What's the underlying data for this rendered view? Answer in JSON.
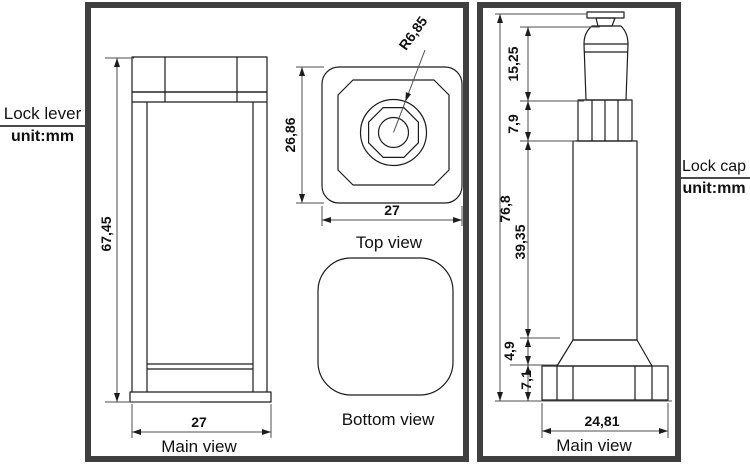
{
  "panels": {
    "lock_lever": {
      "label": {
        "title": "Lock lever",
        "unit": "unit:mm"
      },
      "main_view": {
        "caption": "Main view",
        "dim_height": "67,45",
        "dim_width": "27"
      },
      "top_view": {
        "caption": "Top view",
        "dim_height": "26,86",
        "dim_width": "27",
        "dim_radius": "R6,85"
      },
      "bottom_view": {
        "caption": "Bottom view"
      }
    },
    "lock_cap": {
      "label": {
        "title": "Lock cap",
        "unit": "unit:mm"
      },
      "main_view": {
        "caption": "Main view",
        "dim_overall": "76,8",
        "dim_knob": "15,25",
        "dim_thread": "7,9",
        "dim_body": "39,35",
        "dim_taper": "4,9",
        "dim_flange": "7,1",
        "dim_width": "24,81"
      }
    }
  },
  "colors": {
    "line": "#1c1c1c",
    "dim_line": "#4d4d4d",
    "panel_border": "#3f3f3f",
    "background": "#ffffff"
  }
}
